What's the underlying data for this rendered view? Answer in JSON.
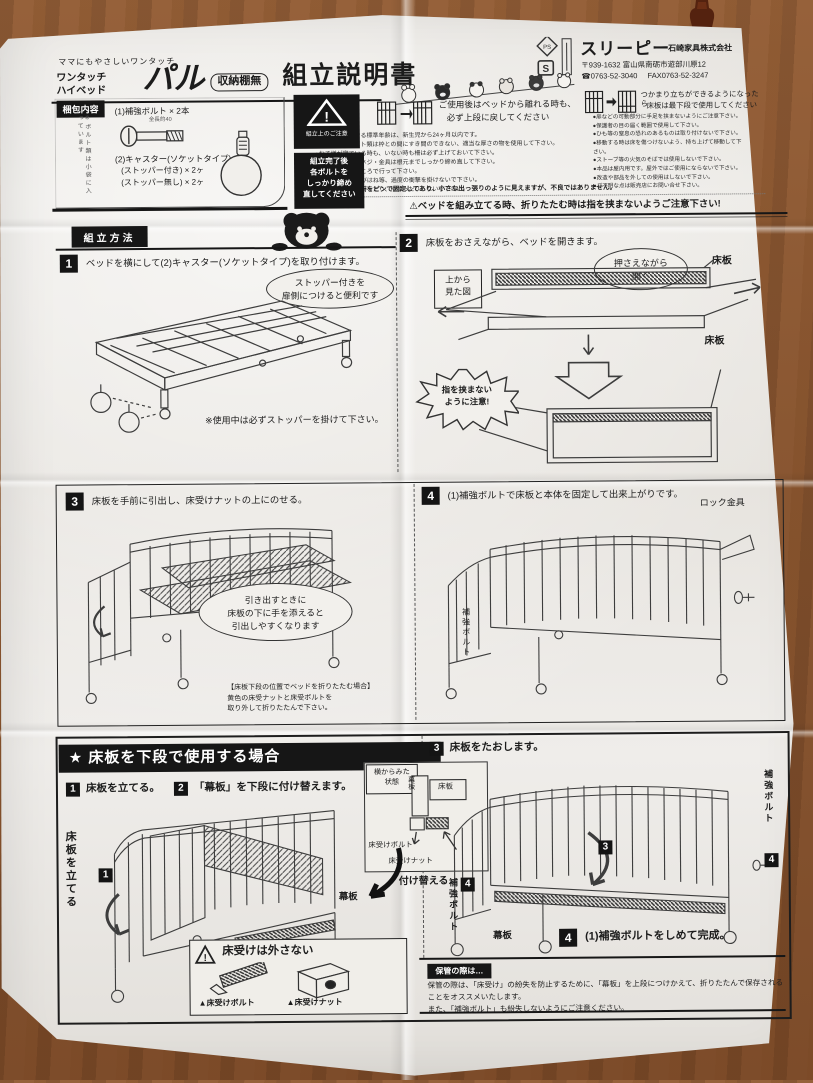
{
  "header": {
    "tagline": "ママにもやさしいワンタッチ",
    "product_line1": "ワンタッチ",
    "product_line2": "ハイベッド",
    "product_name": "パル",
    "variant_box": "収納棚無",
    "doc_title": "組立説明書"
  },
  "company": {
    "name": "スリーピー",
    "corp": "石崎家具株式会社",
    "address": "〒939-1632 富山県南砺市遊部川原12",
    "tel": "☎0763-52-3040",
    "fax": "FAX0763-52-3247"
  },
  "top_notice": {
    "black_caption": "組立上のご注意",
    "retighten": [
      "組立完了後",
      "各ボルトを",
      "しっかり締め",
      "直してください"
    ],
    "usage1a": "ご使用後はベッドから離れる時も、",
    "usage1b": "必ず上段に戻してください",
    "usage2a": "つかまり立ちができるようになったら",
    "usage2b": "床板は最下段で使用してください",
    "bullets_left": [
      "●ご使用いただける標準年齢は、新生児から24ヶ月以内です。",
      "●敷ふとんやマット類は枠との間にすき間のできない、適当な厚さの物を使用して下さい。",
      "●お子様が寝ている時も、いない時も柵は必ず上げておいて下さい。",
      "●ゆるみが出たらネジ・金具は根元までしっかり締め直して下さい。",
      "●組立は平らなところで行って下さい。",
      "●ベッドの上で飛びはね等、過度の衝撃を掛けないで下さい。",
      "●使用時に立ち上がったり、ゆすったりしないで下さい。"
    ],
    "bullets_right": [
      "●扉などの可動部分に手足を挟まないようにご注意下さい。",
      "●保護者の目の届く範囲で使用して下さい。",
      "●ひも等の窒息の恐れのあるものは取り付けないで下さい。",
      "●移動する時は床を傷つけないよう、持ち上げて移動して下さい。",
      "●ストーブ等の火気のそばでは使用しないで下さい。",
      "●本品は屋内用です。屋外ではご使用にならないで下さい。",
      "●改造や部品を外しての使用はしないで下さい。",
      "●ご不明な点は販売店にお問い合せ下さい。"
    ],
    "pin_note": "※本体数ヶ所をピンで固定してあり、小さな出っ張りのように見えますが、不良ではありません。"
  },
  "packing": {
    "label": "梱包内容",
    "item1": "(1)補強ボルト × 2本",
    "item1_sub": "全長約40",
    "item2": "(2)キャスター(ソケットタイプ)",
    "item2a": "(ストッパー付き) × 2ヶ",
    "item2b": "(ストッパー無し) × 2ヶ",
    "side_note": "※ボルト類は小袋に入っています"
  },
  "assembly": {
    "section_label": "組立方法",
    "fold_warning": "⚠ベッドを組み立てる時、折りたたむ時は指を挟まないようご注意下さい!",
    "step1": {
      "num": "1",
      "text": "ベッドを横にして(2)キャスター(ソケットタイプ)を取り付けます。",
      "bubble1": "ストッパー付きを",
      "bubble2": "扉側につけると便利です",
      "note": "※使用中は必ずストッパーを掛けて下さい。"
    },
    "step2": {
      "num": "2",
      "text": "床板をおさえながら、ベッドを開きます。",
      "bubble1": "押さえながら",
      "bubble2": "開く",
      "topview1": "上から",
      "topview2": "見た図",
      "label_floor1": "床板",
      "label_floor2": "床板",
      "pinch1": "指を挟まない",
      "pinch2": "ように注意!"
    },
    "step3": {
      "num": "3",
      "text": "床板を手前に引出し、床受けナットの上にのせる。",
      "bubble": [
        "引き出すときに",
        "床板の下に手を添えると",
        "引出しやすくなります"
      ],
      "note": [
        "【床板下段の位置でベッドを折りたたむ場合】",
        "黄色の床受ナットと床受ボルトを",
        "取り外して折りたたんで下さい。"
      ]
    },
    "step4": {
      "num": "4",
      "text": "(1)補強ボルトで床板と本体を固定して出来上がりです。",
      "label_lock": "ロック金具",
      "label_bolt": "補強ボルト"
    }
  },
  "lower": {
    "banner": "★ 床板を下段で使用する場合",
    "s1_num": "1",
    "s1": "床板を立てる。",
    "s2_num": "2",
    "s2": "「幕板」を下段に付け替えます。",
    "s3_num": "3",
    "s3": "床板をたおします。",
    "s4_num": "4",
    "s4": "(1)補強ボルトをしめて完成。",
    "inset_label1": "横からみた",
    "inset_label2": "状態",
    "inset_maku": "幕板",
    "inset_yuka": "床板",
    "inset_bolt": "床受けボルト",
    "inset_nut": "床受けナット",
    "vert_tate": "床板を立てる",
    "marker1": "1",
    "marker3": "3",
    "marker4a": "4",
    "marker4b": "4",
    "maku_label": "幕板",
    "maku_label2": "幕板",
    "tsukekaeru": "付け替える",
    "vert_bolt_right": "補強ボルト",
    "vert_bolt_left": "補強ボルト",
    "warnbox_title": "床受けは外さない",
    "warn_bolt": "▲床受けボルト",
    "warn_nut": "▲床受けナット"
  },
  "storage": {
    "ribbon": "保管の際は…",
    "line1": "保管の際は、「床受け」の紛失を防止するために、「幕板」を上段につけかえて、折りたたんで保存されることをオススメいたします。",
    "line2": "また、「補強ボルト」も紛失しないようにご注意ください。"
  }
}
